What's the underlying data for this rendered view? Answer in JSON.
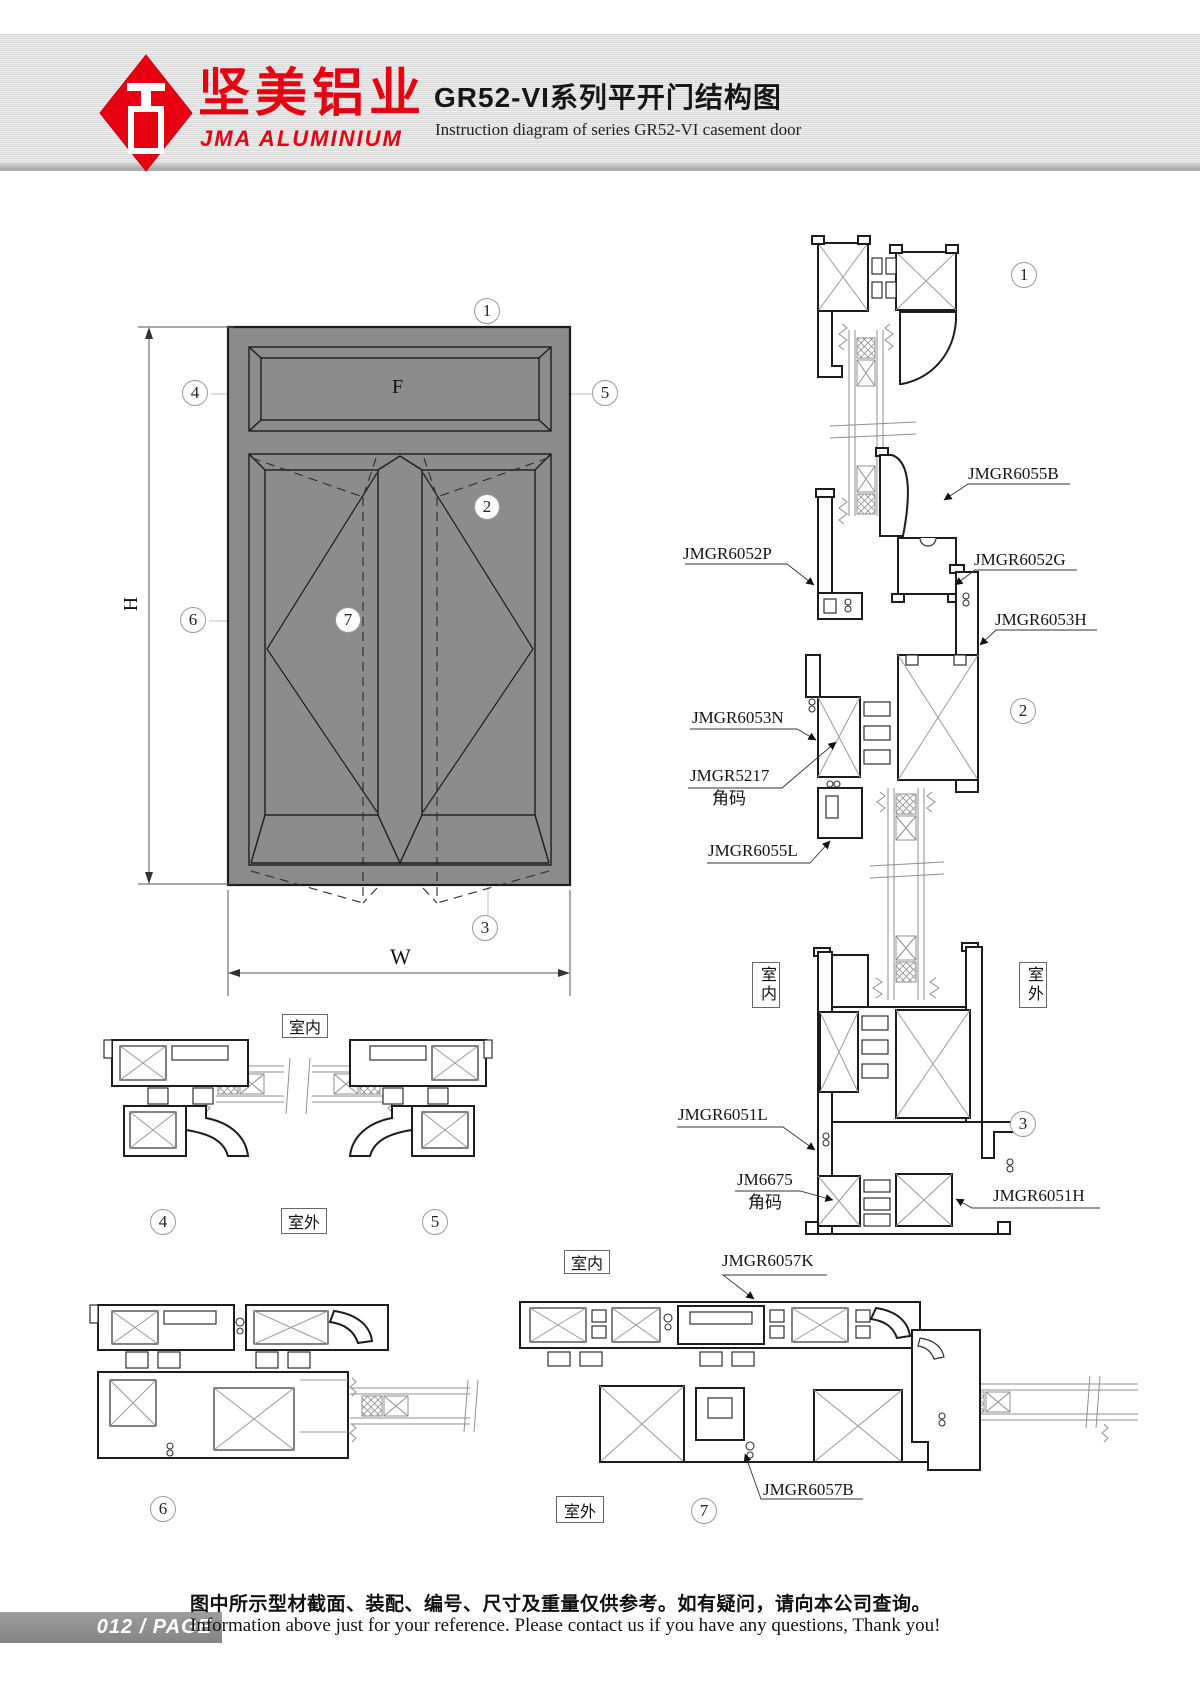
{
  "header": {
    "logo_cn": "坚美铝业",
    "logo_en": "JMA ALUMINIUM",
    "title_cn": "GR52-VI系列平开门结构图",
    "title_en": "Instruction diagram of series GR52-VI casement door"
  },
  "drawing": {
    "dims": {
      "f": "F",
      "h": "H",
      "w": "W"
    },
    "callouts": {
      "c1": "1",
      "c2": "2",
      "c3": "3",
      "c4": "4",
      "c5": "5",
      "c6": "6",
      "c7": "7"
    },
    "rooms": {
      "inside": "室内",
      "outside": "室外"
    },
    "parts": {
      "jmgr6055b": "JMGR6055B",
      "jmgr6052p": "JMGR6052P",
      "jmgr6052g": "JMGR6052G",
      "jmgr6053h": "JMGR6053H",
      "jmgr6053n": "JMGR6053N",
      "jmgr5217": "JMGR5217",
      "jmgr6055l": "JMGR6055L",
      "jmgr6051l": "JMGR6051L",
      "jm6675": "JM6675",
      "jmgr6051h": "JMGR6051H",
      "jmgr6057k": "JMGR6057K",
      "jmgr6057b": "JMGR6057B",
      "corner_code": "角码"
    }
  },
  "footer": {
    "badge": "012 / PAGE",
    "note_cn": "图中所示型材截面、装配、编号、尺寸及重量仅供参考。如有疑问，请向本公司查询。",
    "note_en": "Information above just for your reference. Please contact us if you have any questions, Thank you!"
  },
  "colors": {
    "brand_red": "#e60012",
    "profile_gray": "#8c8c8c",
    "line_dark": "#1c1c1c",
    "band_gray": "#dedede"
  }
}
